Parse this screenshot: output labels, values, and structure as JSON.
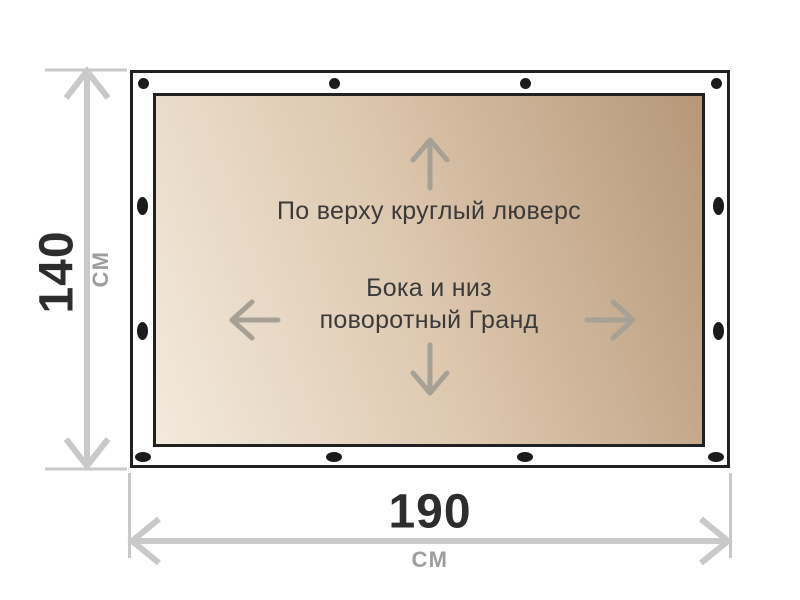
{
  "banner": {
    "top_note": "По верху круглый люверс",
    "center_note_line1": "Бока и низ",
    "center_note_line2": "поворотный Гранд",
    "grommet_count": 12
  },
  "dimensions": {
    "height": {
      "value": "140",
      "unit": "СМ"
    },
    "width": {
      "value": "190",
      "unit": "СМ"
    }
  },
  "icons": {
    "up_arrow": "arrow-up-icon",
    "down_arrow": "arrow-down-icon",
    "left_arrow": "arrow-left-icon",
    "right_arrow": "arrow-right-icon",
    "grommet": "grommet-dot-icon",
    "height_dimension": "vertical-double-arrow-icon",
    "width_dimension": "horizontal-double-arrow-icon"
  },
  "colors": {
    "outline": "#212121",
    "grommet": "#1b1b1b",
    "dimension_value_text": "#2d2d2d",
    "dimension_unit_text": "#9e9e9e",
    "dimension_line": "#c9c9c9",
    "inner_arrow": "#a7a095",
    "note_text": "#3a3a3a",
    "fabric_gradient": [
      "#f3eadd",
      "#ddc7ae",
      "#b69778"
    ],
    "background": "#ffffff"
  }
}
